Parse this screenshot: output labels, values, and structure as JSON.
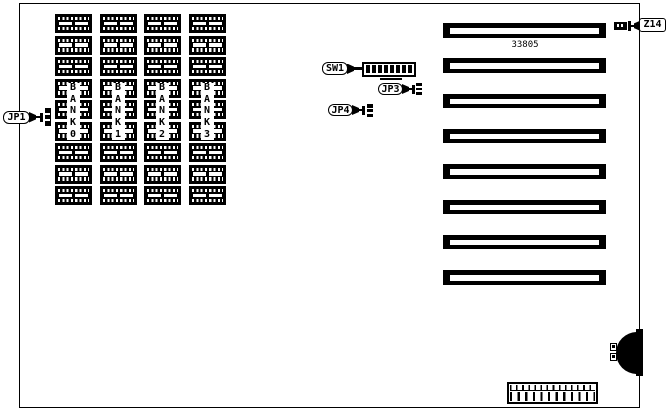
{
  "diagram": {
    "type": "motherboard-jumper-diagram",
    "part_number": "33805",
    "colors": {
      "foreground": "#000000",
      "background": "#ffffff"
    }
  },
  "memory": {
    "chips_per_column": 9,
    "banks": [
      {
        "label": "BANK 0"
      },
      {
        "label": "BANK 1"
      },
      {
        "label": "BANK 2"
      },
      {
        "label": "BANK 3"
      }
    ]
  },
  "callouts": {
    "jp1": "JP1",
    "sw1": "SW1",
    "jp3": "JP3",
    "jp4": "JP4",
    "z14": "Z14"
  },
  "dip_switch": {
    "name": "SW1",
    "positions": 8
  },
  "expansion_slots": {
    "count": 8
  },
  "bottom_connector": {
    "top_pins": 13,
    "bottom_pins": 12
  }
}
